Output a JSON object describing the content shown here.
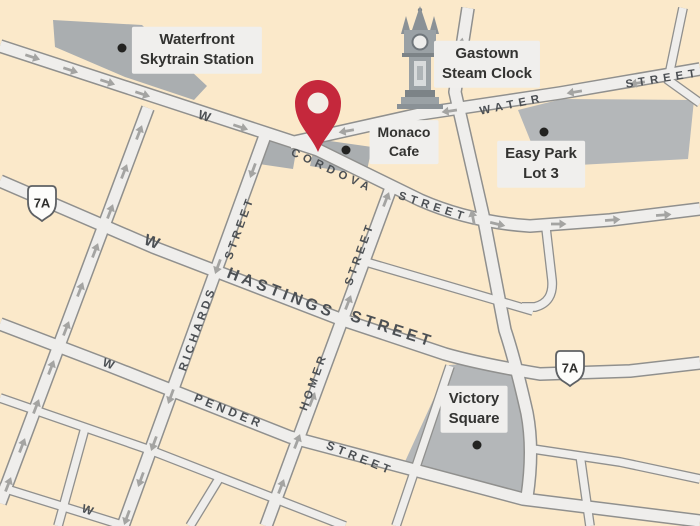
{
  "map": {
    "colors": {
      "background": "#FBE9CA",
      "street_fill": "#EFEEEC",
      "street_casing": "#90908E",
      "arrow": "#A4A4A2",
      "area": "#B4B7B9",
      "area_dark": "#AAAEB0",
      "label_bg": "#F0EFED",
      "label_text": "#333331",
      "street_text": "#4C5054",
      "pin": "#C5283C",
      "pin_hole": "#F3EEE7",
      "dot": "#232321",
      "shield_fill": "#FDFDFB",
      "shield_border": "#5E6164",
      "shield_text": "#2F2F2D"
    },
    "poi_labels": [
      {
        "id": "waterfront-skytrain-station",
        "lines": [
          "Waterfront",
          "Skytrain Station"
        ],
        "x": 197,
        "y": 50,
        "size": 15
      },
      {
        "id": "gastown-steam-clock",
        "lines": [
          "Gastown",
          "Steam Clock"
        ],
        "x": 487,
        "y": 64,
        "size": 15
      },
      {
        "id": "monaco-cafe",
        "lines": [
          "Monaco",
          "Cafe"
        ],
        "x": 404,
        "y": 142,
        "size": 14
      },
      {
        "id": "easy-park-lot-3",
        "lines": [
          "Easy Park",
          "Lot 3"
        ],
        "x": 541,
        "y": 164,
        "size": 15
      },
      {
        "id": "victory-square",
        "lines": [
          "Victory",
          "Square"
        ],
        "x": 474,
        "y": 409,
        "size": 15
      }
    ],
    "street_labels": [
      {
        "text": "W",
        "x": 205,
        "y": 116,
        "rot": 18,
        "size": 13,
        "sp": 1
      },
      {
        "text": "CORDOVA",
        "x": 332,
        "y": 171,
        "rot": 25,
        "size": 11.5,
        "sp": 4.5
      },
      {
        "text": "STREET",
        "x": 433,
        "y": 207,
        "rot": 18,
        "size": 11.5,
        "sp": 4.5
      },
      {
        "text": "WATER",
        "x": 512,
        "y": 105,
        "rot": -12,
        "size": 11.5,
        "sp": 5
      },
      {
        "text": "STREET",
        "x": 663,
        "y": 79,
        "rot": -9,
        "size": 11.5,
        "sp": 5
      },
      {
        "text": "W",
        "x": 152,
        "y": 243,
        "rot": 21,
        "size": 16,
        "sp": 1
      },
      {
        "text": "HASTINGS",
        "x": 281,
        "y": 294,
        "rot": 21,
        "size": 16,
        "sp": 4
      },
      {
        "text": "STREET",
        "x": 392,
        "y": 330,
        "rot": 18,
        "size": 16,
        "sp": 4
      },
      {
        "text": "W",
        "x": 109,
        "y": 364,
        "rot": 21,
        "size": 12,
        "sp": 1
      },
      {
        "text": "PENDER",
        "x": 229,
        "y": 411,
        "rot": 22,
        "size": 12,
        "sp": 4
      },
      {
        "text": "STREET",
        "x": 360,
        "y": 458,
        "rot": 22,
        "size": 12,
        "sp": 4
      },
      {
        "text": "STREET",
        "x": 240,
        "y": 228,
        "rot": -70,
        "size": 11.5,
        "sp": 3.5
      },
      {
        "text": "RICHARDS",
        "x": 198,
        "y": 329,
        "rot": -70,
        "size": 11.5,
        "sp": 3.5
      },
      {
        "text": "STREET",
        "x": 360,
        "y": 254,
        "rot": -70,
        "size": 11.5,
        "sp": 3.5
      },
      {
        "text": "HOMER",
        "x": 314,
        "y": 382,
        "rot": -70,
        "size": 11.5,
        "sp": 3.5
      },
      {
        "text": "W",
        "x": 88,
        "y": 510,
        "rot": 20,
        "size": 12,
        "sp": 1
      }
    ],
    "highway_shields": [
      {
        "label": "7A",
        "x": 42,
        "y": 203
      },
      {
        "label": "7A",
        "x": 570,
        "y": 368
      }
    ],
    "poi_dots": [
      {
        "id": "waterfront-station-dot",
        "x": 122,
        "y": 48
      },
      {
        "id": "monaco-cafe-dot",
        "x": 346,
        "y": 150
      },
      {
        "id": "easy-park-dot",
        "x": 544,
        "y": 132
      },
      {
        "id": "victory-square-dot",
        "x": 477,
        "y": 445
      }
    ],
    "one_way_arrows": [
      {
        "x": 32,
        "y": 57,
        "rot": 18
      },
      {
        "x": 70,
        "y": 70,
        "rot": 18
      },
      {
        "x": 107,
        "y": 82,
        "rot": 18
      },
      {
        "x": 142,
        "y": 94,
        "rot": 18
      },
      {
        "x": 240,
        "y": 127,
        "rot": 18
      },
      {
        "x": 497,
        "y": 224,
        "rot": 13
      },
      {
        "x": 558,
        "y": 224,
        "rot": 0
      },
      {
        "x": 612,
        "y": 220,
        "rot": -4
      },
      {
        "x": 663,
        "y": 215,
        "rot": -4
      },
      {
        "x": 347,
        "y": 131,
        "rot": 170
      },
      {
        "x": 450,
        "y": 111,
        "rot": 172
      },
      {
        "x": 575,
        "y": 92,
        "rot": 171
      },
      {
        "x": 638,
        "y": 83,
        "rot": 171
      },
      {
        "x": 139,
        "y": 133,
        "rot": -69
      },
      {
        "x": 124,
        "y": 172,
        "rot": -69
      },
      {
        "x": 110,
        "y": 212,
        "rot": -69
      },
      {
        "x": 95,
        "y": 251,
        "rot": -69
      },
      {
        "x": 80,
        "y": 290,
        "rot": -69
      },
      {
        "x": 66,
        "y": 329,
        "rot": -69
      },
      {
        "x": 51,
        "y": 368,
        "rot": -69
      },
      {
        "x": 36,
        "y": 407,
        "rot": -69
      },
      {
        "x": 22,
        "y": 446,
        "rot": -69
      },
      {
        "x": 8,
        "y": 485,
        "rot": -69
      },
      {
        "x": 253,
        "y": 170,
        "rot": 110
      },
      {
        "x": 218,
        "y": 266,
        "rot": 110
      },
      {
        "x": 171,
        "y": 396,
        "rot": 110
      },
      {
        "x": 154,
        "y": 443,
        "rot": 110
      },
      {
        "x": 141,
        "y": 479,
        "rot": 110
      },
      {
        "x": 127,
        "y": 517,
        "rot": 110
      },
      {
        "x": 386,
        "y": 200,
        "rot": -69
      },
      {
        "x": 348,
        "y": 303,
        "rot": -69
      },
      {
        "x": 312,
        "y": 400,
        "rot": -69
      },
      {
        "x": 297,
        "y": 442,
        "rot": -69
      },
      {
        "x": 281,
        "y": 487,
        "rot": -69
      },
      {
        "x": 473,
        "y": 218,
        "rot": -101
      },
      {
        "x": 461,
        "y": 46,
        "rot": -80
      }
    ]
  }
}
